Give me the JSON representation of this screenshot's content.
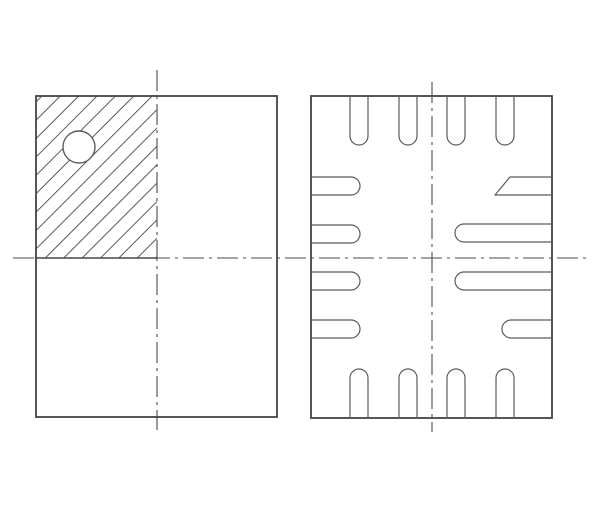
{
  "app": {
    "type": "technical-drawing",
    "subject": "IC package outline drawing: top view (left, with hatched pin-1 quadrant and index circle) and bottom pad view (right, with chamfered pin-1 pad)"
  },
  "canvas": {
    "width": 600,
    "height": 514,
    "background": "#ffffff"
  },
  "colors": {
    "outline": "#434343",
    "pad_line": "#5a5a5a",
    "centerline": "#4a4a4a",
    "hatch_line": "#5a5a5a",
    "circle_line": "#5a5a5a",
    "white": "#ffffff"
  },
  "stroke_widths": {
    "outline": 1.8,
    "pad": 1.2,
    "centerline": 1.1,
    "hatch": 1.0,
    "circle": 1.4,
    "hatch_boundary": 1.4
  },
  "centerline_dash": "21 5 3 5",
  "horizontal_centerline": {
    "y": 258,
    "x1": 13,
    "x2": 587
  },
  "top_view": {
    "outline": {
      "x": 36,
      "y": 96,
      "width": 241,
      "height": 321
    },
    "vertical_centerline": {
      "x": 157,
      "y1": 70,
      "y2": 430
    },
    "hatch_region": {
      "x": 36,
      "y": 96,
      "width": 121,
      "height": 162
    },
    "hatch_spacing": 13,
    "hatch_boundary": {
      "x1": 36,
      "y1": 258,
      "x2": 157,
      "y2": 258
    },
    "pin1_circle": {
      "cx": 79,
      "cy": 147,
      "r": 16
    }
  },
  "bottom_view": {
    "outline": {
      "x": 311,
      "y": 96,
      "width": 241,
      "height": 322
    },
    "vertical_centerline": {
      "x": 432,
      "y1": 82,
      "y2": 432
    },
    "pad_width": 18,
    "pad_end_radius": 9,
    "top_pads": {
      "edge_y": 96,
      "straight_end_y": 136,
      "xs": [
        350,
        399,
        447,
        496
      ]
    },
    "bottom_pads": {
      "edge_y": 418,
      "straight_end_y": 378,
      "xs": [
        350,
        399,
        447,
        496
      ]
    },
    "left_pads": {
      "edge_x": 311,
      "straight_end_x": 351,
      "ys": [
        177,
        225,
        272,
        320
      ]
    },
    "right_pads": [
      {
        "kind": "chamfered",
        "edge_x": 552,
        "y_top": 177,
        "y_bottom": 195,
        "tip_x": 495,
        "chamfer_start_x": 510
      },
      {
        "kind": "rounded",
        "edge_x": 552,
        "y": 224,
        "straight_end_x": 464
      },
      {
        "kind": "rounded",
        "edge_x": 552,
        "y": 272,
        "straight_end_x": 464
      },
      {
        "kind": "rounded",
        "edge_x": 552,
        "y": 320,
        "straight_end_x": 511
      }
    ]
  }
}
